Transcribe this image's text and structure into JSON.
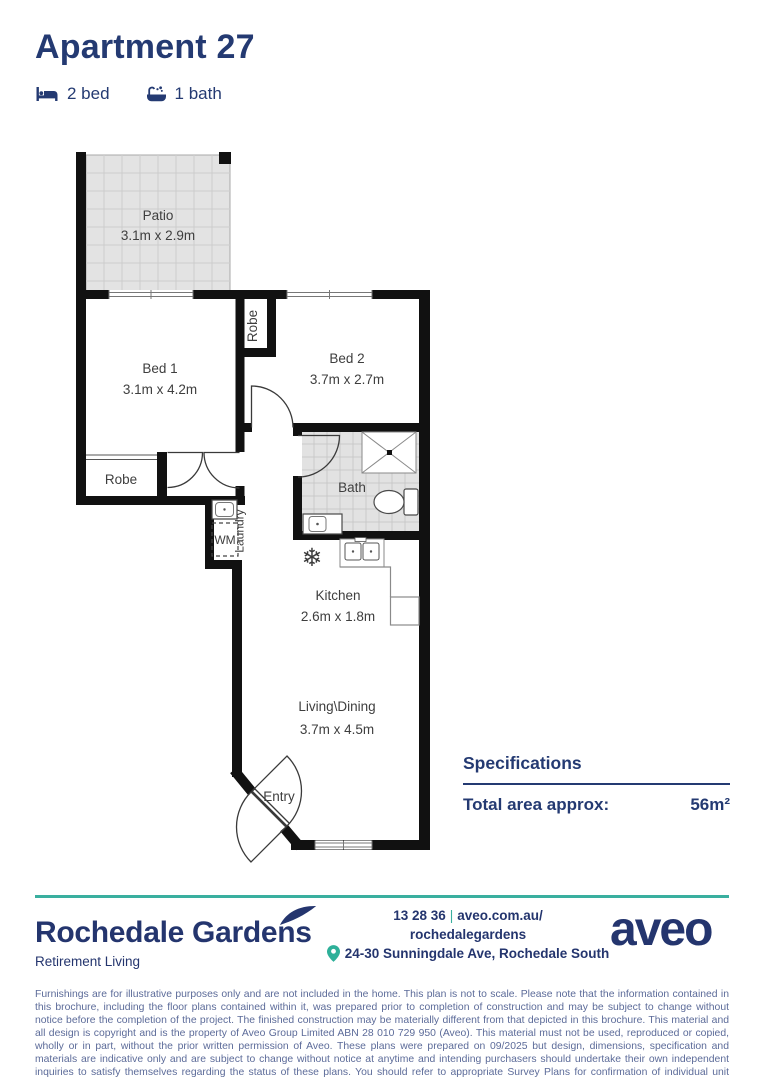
{
  "header": {
    "title": "Apartment 27",
    "bed_label": "2 bed",
    "bath_label": "1 bath"
  },
  "plan": {
    "patio": {
      "name": "Patio",
      "dims": "3.1m x 2.9m"
    },
    "bed1": {
      "name": "Bed 1",
      "dims": "3.1m x 4.2m"
    },
    "bed2": {
      "name": "Bed 2",
      "dims": "3.7m x 2.7m"
    },
    "bath": {
      "name": "Bath"
    },
    "kitchen": {
      "name": "Kitchen",
      "dims": "2.6m x 1.8m"
    },
    "living": {
      "name": "Living\\Dining",
      "dims": "3.7m x 4.5m"
    },
    "robe_top": "Robe",
    "robe_bottom": "Robe",
    "laundry": "Laundry",
    "wm": "WM",
    "entry": "Entry",
    "fridge_icon": "❄"
  },
  "specifications": {
    "heading": "Specifications",
    "total_area_label": "Total area approx:",
    "total_area_value": "56m²"
  },
  "footer": {
    "community_name": "Rochedale Gardens",
    "community_tagline": "Retirement Living",
    "phone": "13 28 36",
    "separator": "|",
    "website_line1": "aveo.com.au/",
    "website_line2": "rochedalegardens",
    "address": "24-30 Sunningdale Ave, Rochedale South",
    "brand": "aveo"
  },
  "disclaimer": "Furnishings are for illustrative purposes only and are not included in the home. This plan is not to scale. Please note that the information contained in this brochure, including the floor plans contained within it, was prepared prior to completion of construction and may be subject to change without notice before the completion of the project. The finished construction may be materially different from that depicted in this brochure. This material and all design is copyright and is the property of Aveo Group Limited ABN 28 010 729 950 (Aveo). This material must not be used, reproduced or copied, wholly or in part, without the prior written permission of Aveo. These plans were prepared on 09/2025 but design, dimensions, specification and materials are indicative only and are subject to change without notice at anytime and intending purchasers should undertake their own independent inquiries to satisfy themselves regarding the status of these plans. You should refer to appropriate Survey Plans for confirmation of individual unit areas.",
  "colors": {
    "navy": "#243a72",
    "teal": "#3aaf9f",
    "wall": "#111111",
    "tile": "#e3e3e3"
  }
}
